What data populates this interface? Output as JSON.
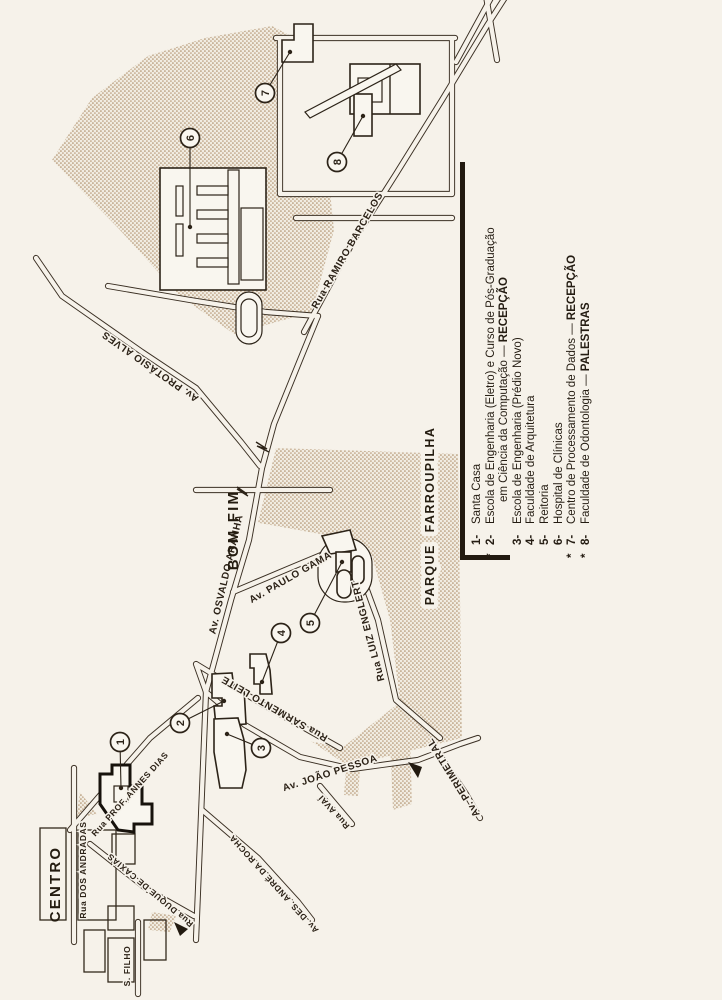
{
  "map_title": "Mapa do campus e centro de Porto Alegre",
  "regions": {
    "centro": "CENTRO",
    "bom_fim": "BOM FIM",
    "parque": "PARQUE FARROUPILHA"
  },
  "streets": {
    "ramiro": "Rua RAMIRO BARCELOS",
    "protasio": "Av. PROTÁSIO ALVES",
    "osvaldo": "Av. OSVALDO ARANHA",
    "paulo_gama": "Av. PAULO GAMA",
    "luiz_englert": "Rua LUIZ ENGLERT",
    "sarmento": "Rua SARMENTO LEITE",
    "joao_pessoa": "Av. JOÃO PESSOA",
    "avai": "Rua AVAÍ",
    "andre_rocha": "Av. DES. ANDRÉ DA ROCHA",
    "annes_dias": "Rua PROF. ANNES DIAS",
    "andradas": "Rua DOS ANDRADAS",
    "caxias": "Rua DUQUE DE CAXIAS",
    "perimetral": "Av. PERIMETRAL",
    "s_filho": "S. FILHO"
  },
  "markers": {
    "labels": [
      "1",
      "2",
      "3",
      "4",
      "5",
      "6",
      "7",
      "8"
    ]
  },
  "legend": {
    "items": [
      {
        "star": "",
        "num": "1-",
        "text": "Santa Casa",
        "bold": ""
      },
      {
        "star": "*",
        "num": "2-",
        "text": "Escola de Engenharia (Eletro) e Curso de Pós-Graduação",
        "bold": ""
      },
      {
        "star": "",
        "num": "",
        "text": "em Ciência da Computação — ",
        "bold": "RECEPÇÃO"
      },
      {
        "star": "",
        "num": "3-",
        "text": "Escola de Engenharia (Prédio Novo)",
        "bold": ""
      },
      {
        "star": "",
        "num": "4-",
        "text": "Faculdade de Arquitetura",
        "bold": ""
      },
      {
        "star": "",
        "num": "5-",
        "text": "Reitoria",
        "bold": ""
      },
      {
        "star": "",
        "num": "6-",
        "text": "Hospital de Clínicas",
        "bold": ""
      },
      {
        "star": "*",
        "num": "7-",
        "text": "Centro de Processamento de Dados — ",
        "bold": "RECEPÇÃO"
      },
      {
        "star": "*",
        "num": "8-",
        "text": "Faculdade de Odontologia — ",
        "bold": "PALESTRAS"
      }
    ]
  }
}
